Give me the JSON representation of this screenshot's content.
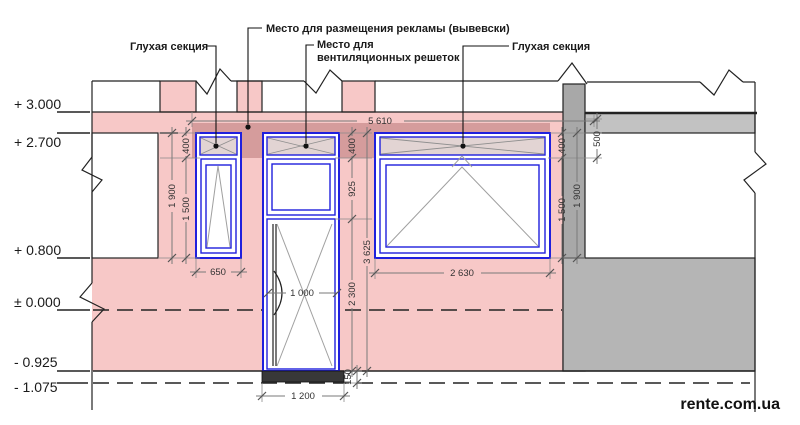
{
  "levels": {
    "lv3000": "+ 3.000",
    "lv2700": "+ 2.700",
    "lv0800": "+ 0.800",
    "lv0000": "± 0.000",
    "lvm0925": "- 0.925",
    "lvm1075": "- 1.075"
  },
  "callouts": {
    "blind_left": "Глухая секция",
    "ad": "Место для размещения рекламы (вывевски)",
    "vent1": "Место для",
    "vent2": "вентиляционных решеток",
    "blind_right": "Глухая секция"
  },
  "dims": {
    "d5610": "5 610",
    "d400l": "400",
    "d1900l": "1 900",
    "d1500l": "1 500",
    "d650": "650",
    "d400m": "400",
    "d925": "925",
    "d3625": "3 625",
    "d2300": "2 300",
    "d1000": "1 000",
    "d150": "150",
    "d1200": "1 200",
    "d2630": "2 630",
    "d400r": "400",
    "d500": "500",
    "d1900r": "1 900",
    "d1500r": "1 500"
  },
  "watermark": "rente.com.ua",
  "colors": {
    "wall_pink": "#f7c8c7",
    "ad_band": "#d59c9c",
    "blind_fill": "#e2d4d3",
    "frame_blue": "#2020dd",
    "wall_grey": "#b5b5b5",
    "pier_grey": "#a8a8a8",
    "slab_grey": "#c2c2c2",
    "outline": "#222222",
    "dim_grey": "#777777"
  }
}
